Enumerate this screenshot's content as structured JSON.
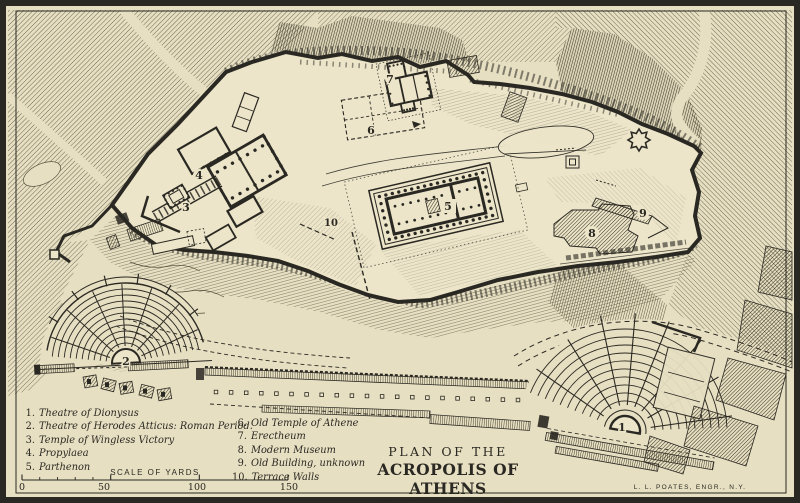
{
  "map": {
    "numbers": [
      "1",
      "2",
      "3",
      "4",
      "5",
      "6",
      "7",
      "8",
      "9",
      "10"
    ],
    "legend": {
      "left": [
        {
          "num": "1.",
          "label": "Theatre of Dionysus"
        },
        {
          "num": "2.",
          "label": "Theatre of Herodes Atticus: Roman Period."
        },
        {
          "num": "3.",
          "label": "Temple of Wingless Victory"
        },
        {
          "num": "4.",
          "label": "Propylaea"
        },
        {
          "num": "5.",
          "label": "Parthenon"
        }
      ],
      "right": [
        {
          "num": "6.",
          "label": "Old Temple of Athene"
        },
        {
          "num": "7.",
          "label": "Erectheum"
        },
        {
          "num": "8.",
          "label": "Modern Museum"
        },
        {
          "num": "9.",
          "label": "Old Building, unknown"
        },
        {
          "num": "10.",
          "label": "Terrace Walls"
        }
      ]
    },
    "scale": {
      "label": "SCALE OF YARDS",
      "ticks": [
        "0",
        "50",
        "100",
        "150"
      ]
    },
    "title": {
      "line1": "PLAN OF THE",
      "line2": "ACROPOLIS OF ATHENS",
      "line3": "(BOETTICHER, WITH OMISSIONS)"
    },
    "credit": "L. L. POATES, ENGR., N.Y.",
    "colors": {
      "paper": "#e7dfc2",
      "plateau": "#ece5c9",
      "ink": "#2a2822"
    }
  }
}
